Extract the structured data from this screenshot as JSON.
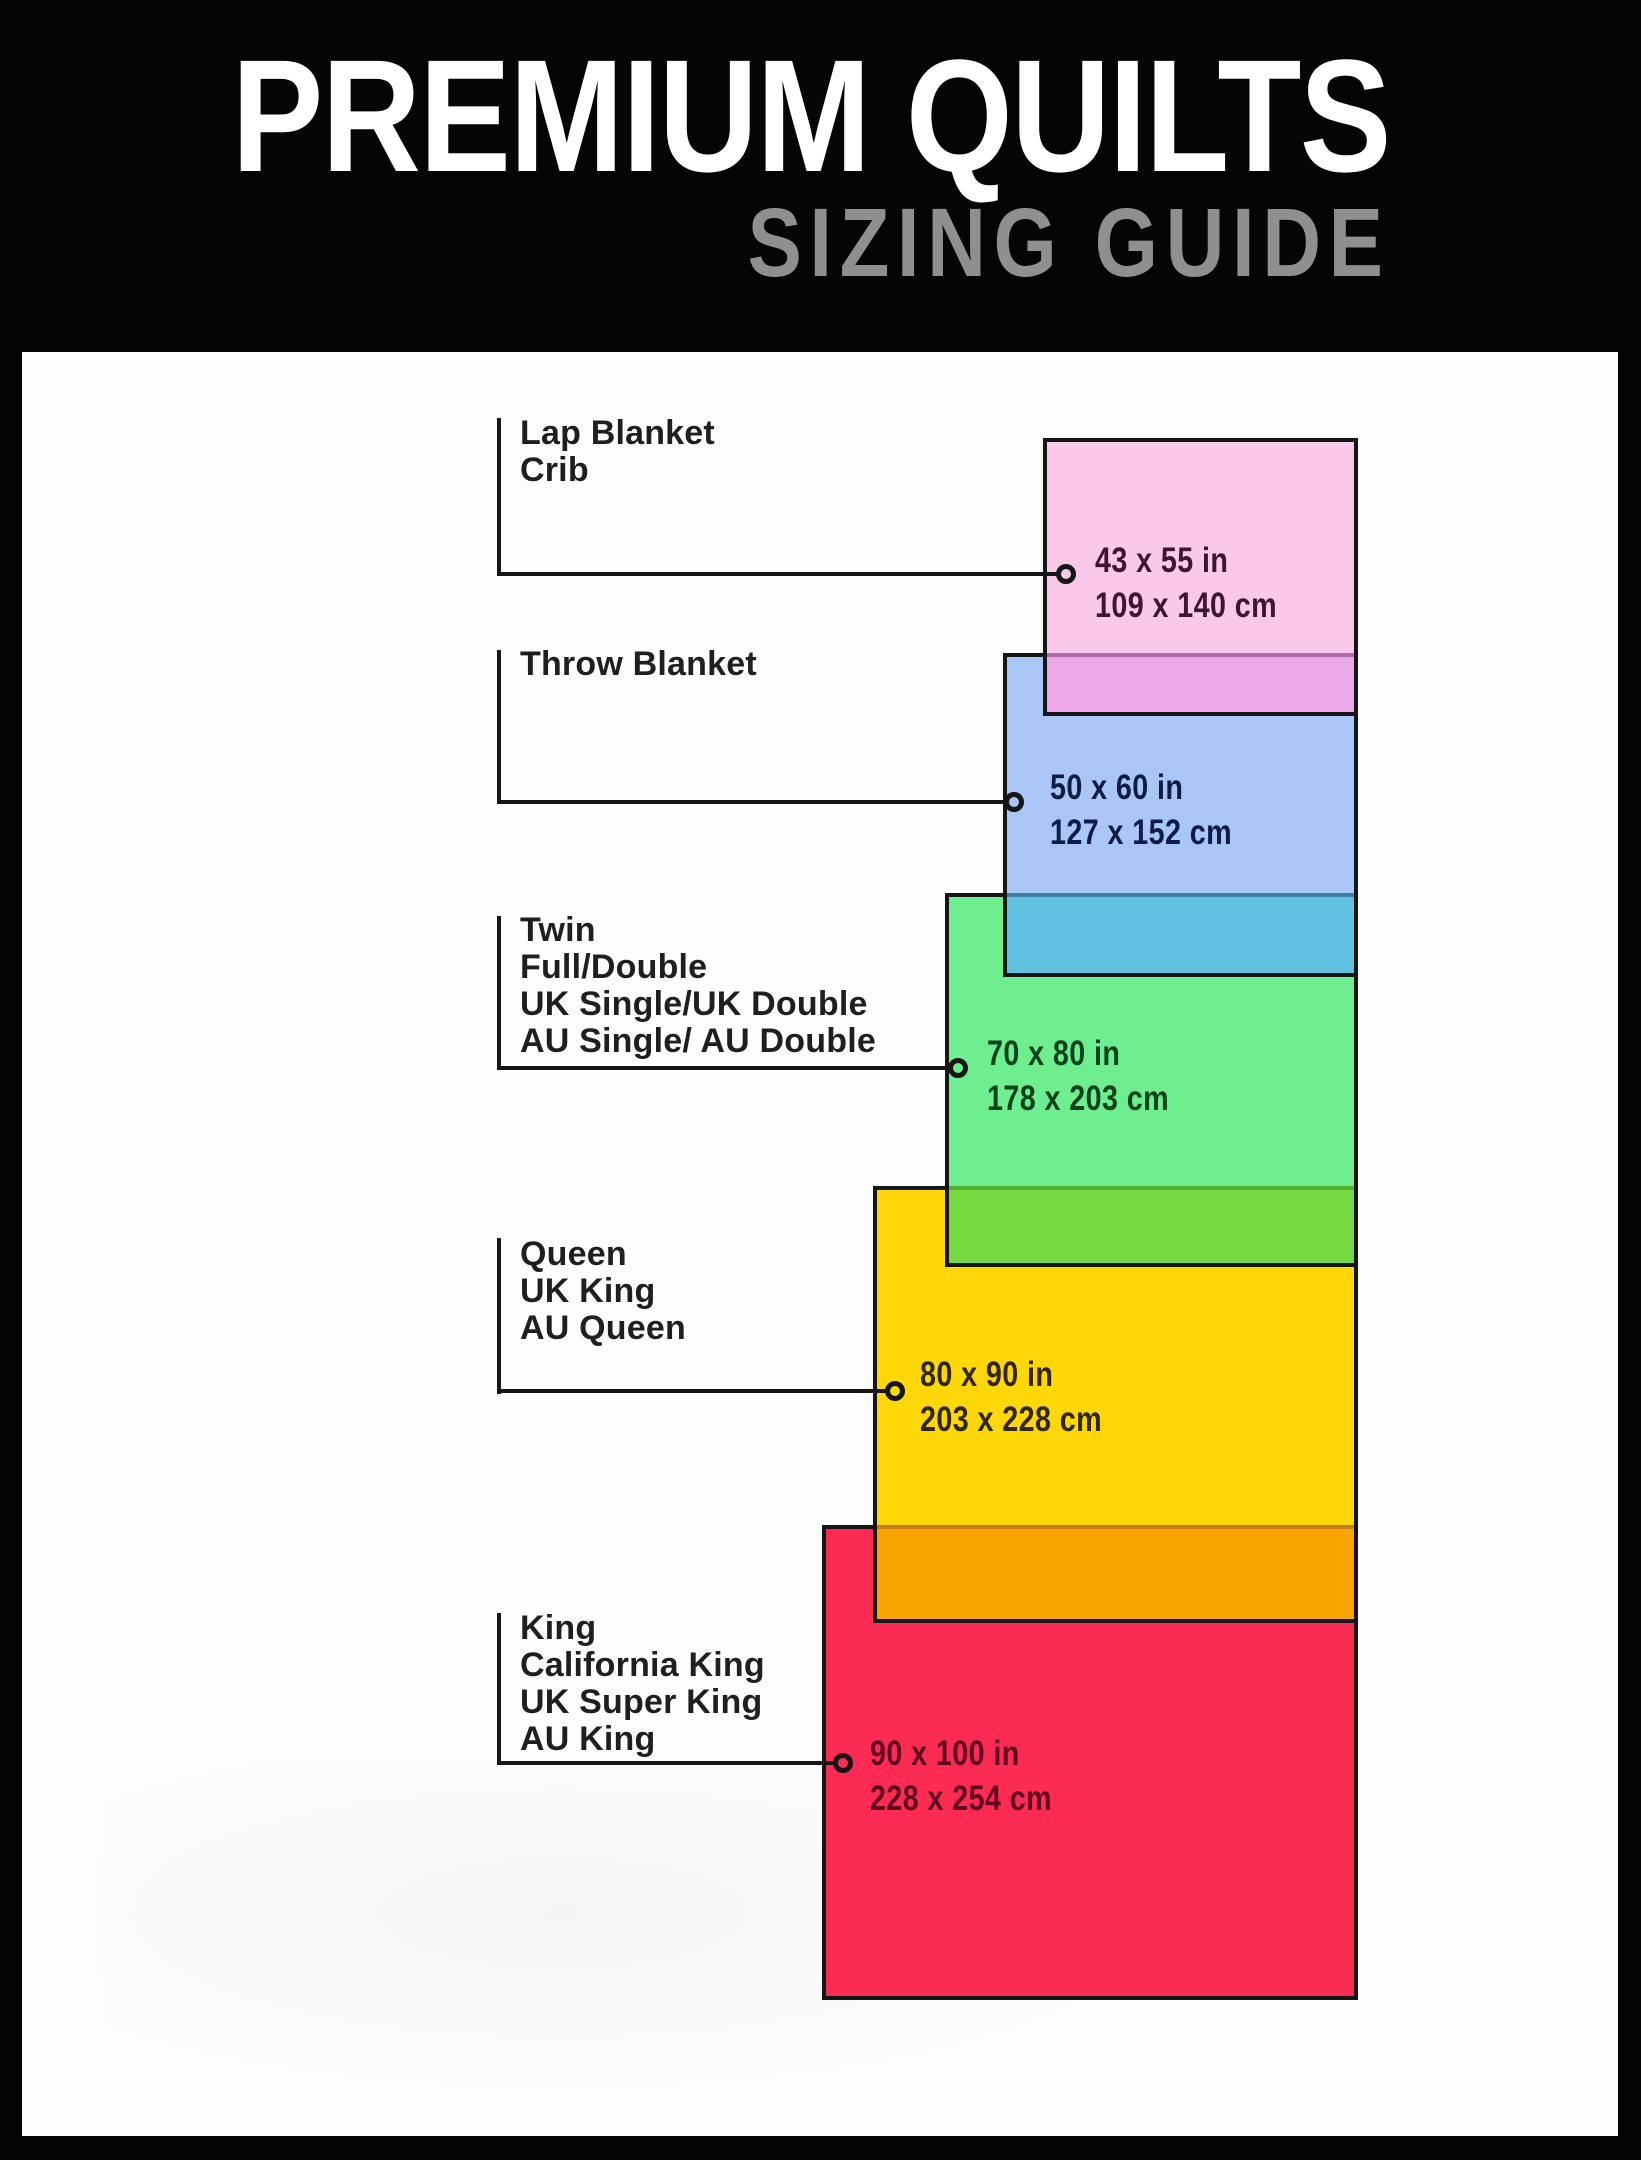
{
  "header": {
    "title": "PREMIUM QUILTS",
    "subtitle": "SIZING GUIDE",
    "background": "#050505",
    "title_color": "#ffffff",
    "subtitle_color": "#8f8f8f"
  },
  "board_background": "#fdfdfd",
  "line_color": "#161616",
  "sizes": [
    {
      "id": "lap-blanket-crib",
      "names": [
        "Lap Blanket",
        "Crib"
      ],
      "inches": "43 x 55 in",
      "cm": "109 x 140 cm",
      "fill": "#fac8e9",
      "overlap_on_next": "#eaa8e9",
      "dims_color": "#3c1634"
    },
    {
      "id": "throw-blanket",
      "names": [
        "Throw Blanket"
      ],
      "inches": "50 x 60 in",
      "cm": "127 x 152 cm",
      "fill": "#a9c6f6",
      "overlap_on_next": "#60c1e0",
      "dims_color": "#101c46"
    },
    {
      "id": "twin-full-double",
      "names": [
        "Twin",
        "Full/Double",
        "UK Single/UK Double",
        "AU Single/ AU Double"
      ],
      "inches": "70 x 80 in",
      "cm": "178 x 203 cm",
      "fill": "#6fee90",
      "overlap_on_next": "#75da3f",
      "dims_color": "#0a431c"
    },
    {
      "id": "queen",
      "names": [
        "Queen",
        "UK King",
        "AU Queen"
      ],
      "inches": "80 x 90 in",
      "cm": "203 x 228 cm",
      "fill": "#fdd707",
      "overlap_on_next": "#f9a401",
      "dims_color": "#32270a"
    },
    {
      "id": "king",
      "names": [
        "King",
        "California King",
        "UK Super King",
        "AU King"
      ],
      "inches": "90 x 100 in",
      "cm": "228 x 254 cm",
      "fill": "#fb2b53",
      "dims_color": "#62081f"
    }
  ]
}
